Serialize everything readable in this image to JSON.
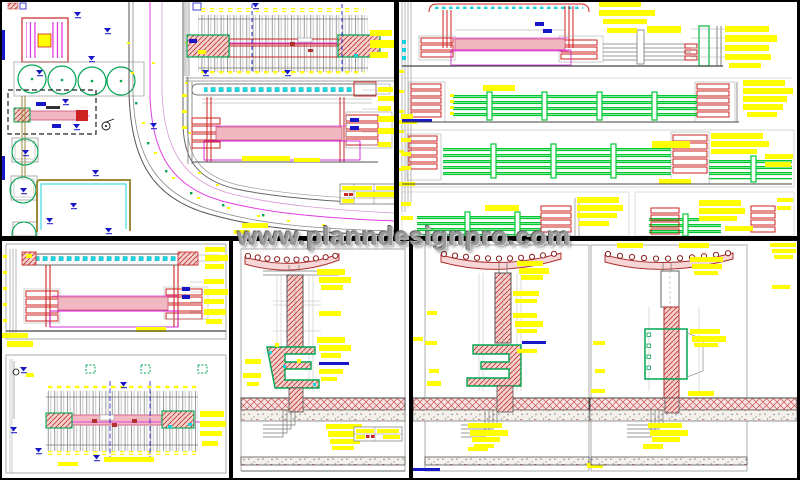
{
  "watermark": {
    "text": "www.planndesignpro.com",
    "color": "#999999"
  },
  "canvas": {
    "width": 800,
    "height": 480,
    "background": "#000000",
    "panel_background": "#ffffff"
  },
  "palette": {
    "annotation_highlight": "#ffff00",
    "rail_green": "#00c832",
    "tree_green": "#00a651",
    "brick_red": "#cc2222",
    "dark_red": "#b03030",
    "beam_pink_fill": "#f2b8c2",
    "magenta": "#e23de2",
    "purple_outline": "#cc00cc",
    "cyan": "#19d3dd",
    "marker_blue": "#1717c8",
    "line_gray": "#888888",
    "dark_line": "#444444",
    "path_olive": "#9a8a3a"
  },
  "panels": [
    {
      "id": "site-plan",
      "position": "top-left"
    },
    {
      "id": "railing-elevations",
      "position": "top-right"
    },
    {
      "id": "elevation-and-pergola-plan",
      "position": "bottom-left"
    },
    {
      "id": "bench-column-section",
      "position": "bottom-center"
    },
    {
      "id": "bench-column-sections-pair",
      "position": "bottom-right"
    }
  ]
}
